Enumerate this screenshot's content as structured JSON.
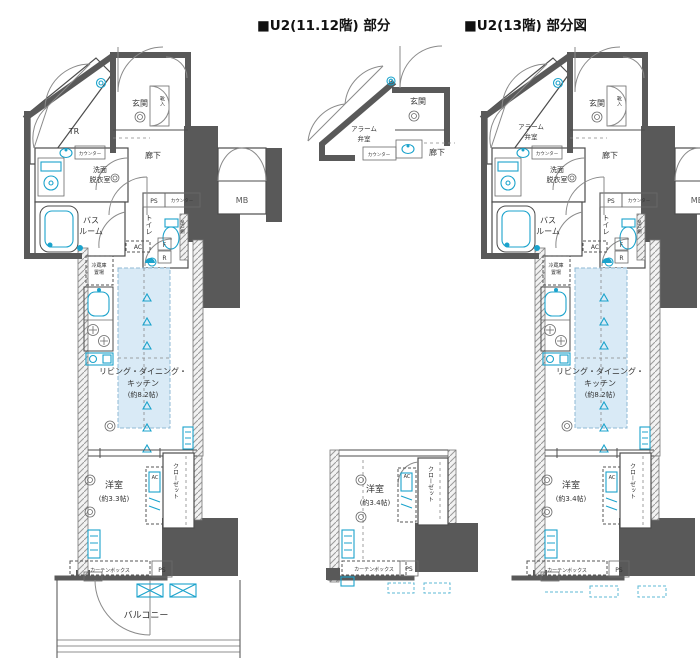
{
  "titles": {
    "left": "■U2(11.12階) 部分",
    "right": "■U2(13階) 部分図"
  },
  "colors": {
    "wall": "#595959",
    "fixture_cyan": "#1ba3cc",
    "ldk_fill": "#d9eaf6",
    "text": "#333333",
    "background": "#ffffff"
  },
  "left": {
    "tr": "TR",
    "genkan": "玄関",
    "kutsuire": "靴入",
    "rouka": "廊下",
    "senmen1": "洗面",
    "senmen2": "脱衣室",
    "counter_top": "カウンター",
    "bath1": "バス",
    "bath2": "ルーム",
    "toilet": "トイレ",
    "tsurido": "吊戸棚",
    "ps_top": "PS",
    "counter_mid": "カウンター",
    "mb": "MB",
    "fridge1": "冷蔵庫",
    "fridge2": "置場",
    "ac_top": "AC",
    "f": "F",
    "r": "R",
    "ldk1": "リビング・ダイニング・",
    "ldk2": "キッチン",
    "ldk3": "(約8.2帖)",
    "yoshitsu": "洋室",
    "yoshitsu_area": "(約3.3帖)",
    "closet": "クローゼット",
    "ac_bed": "AC",
    "curtain": "カーテンボックス",
    "ps_bottom": "PS",
    "balcony": "バルコニー"
  },
  "middle": {
    "alarm1": "アラーム",
    "alarm2": "弁室",
    "genkan": "玄関",
    "counter": "カウンター",
    "rouka": "廊下",
    "yoshitsu": "洋室",
    "yoshitsu_area": "(約3.4帖)",
    "closet": "クローゼット",
    "ac": "AC",
    "curtain": "カーテンボックス",
    "ps": "PS"
  },
  "right": {
    "alarm1": "アラーム",
    "alarm2": "弁室",
    "genkan": "玄関",
    "kutsuire": "靴入",
    "rouka": "廊下",
    "senmen1": "洗面",
    "senmen2": "脱衣室",
    "counter_top": "カウンター",
    "bath1": "バス",
    "bath2": "ルーム",
    "toilet": "トイレ",
    "tsurido": "吊戸棚",
    "ps_top": "PS",
    "counter_mid": "カウンター",
    "mb": "MB",
    "fridge1": "冷蔵庫",
    "fridge2": "置場",
    "ac_top": "AC",
    "f": "F",
    "r": "R",
    "ldk1": "リビング・ダイニング・",
    "ldk2": "キッチン",
    "ldk3": "(約8.2帖)",
    "yoshitsu": "洋室",
    "yoshitsu_area": "(約3.4帖)",
    "closet": "クローゼット",
    "ac_bed": "AC",
    "curtain": "カーテンボックス",
    "ps_bottom": "PS"
  }
}
